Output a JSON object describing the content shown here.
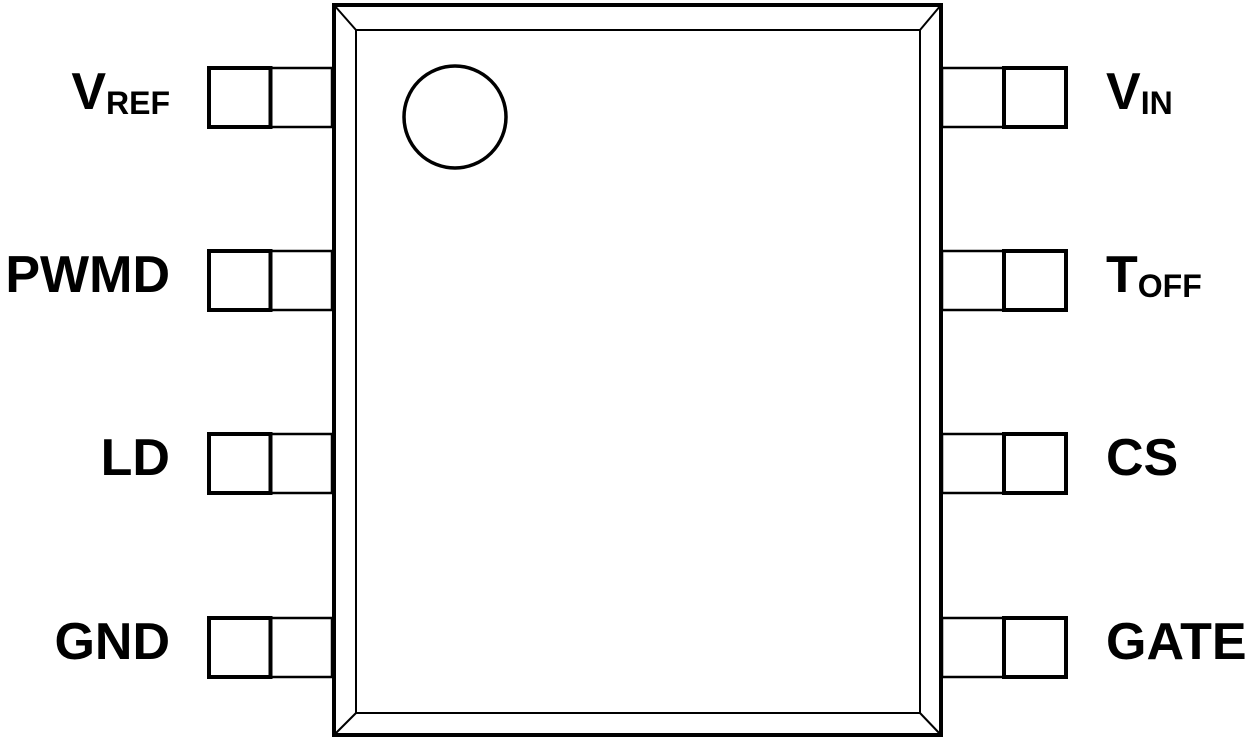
{
  "diagram": {
    "type": "ic-package-pinout",
    "package_style": "8-pin dual-in-line top view",
    "colors": {
      "line": "#000000",
      "background": "#ffffff"
    },
    "pins": {
      "left": [
        {
          "main": "V",
          "sub": "REF"
        },
        {
          "main": "PWMD",
          "sub": ""
        },
        {
          "main": "LD",
          "sub": ""
        },
        {
          "main": "GND",
          "sub": ""
        }
      ],
      "right": [
        {
          "main": "V",
          "sub": "IN"
        },
        {
          "main": "T",
          "sub": "OFF"
        },
        {
          "main": "CS",
          "sub": ""
        },
        {
          "main": "GATE",
          "sub": ""
        }
      ]
    }
  }
}
